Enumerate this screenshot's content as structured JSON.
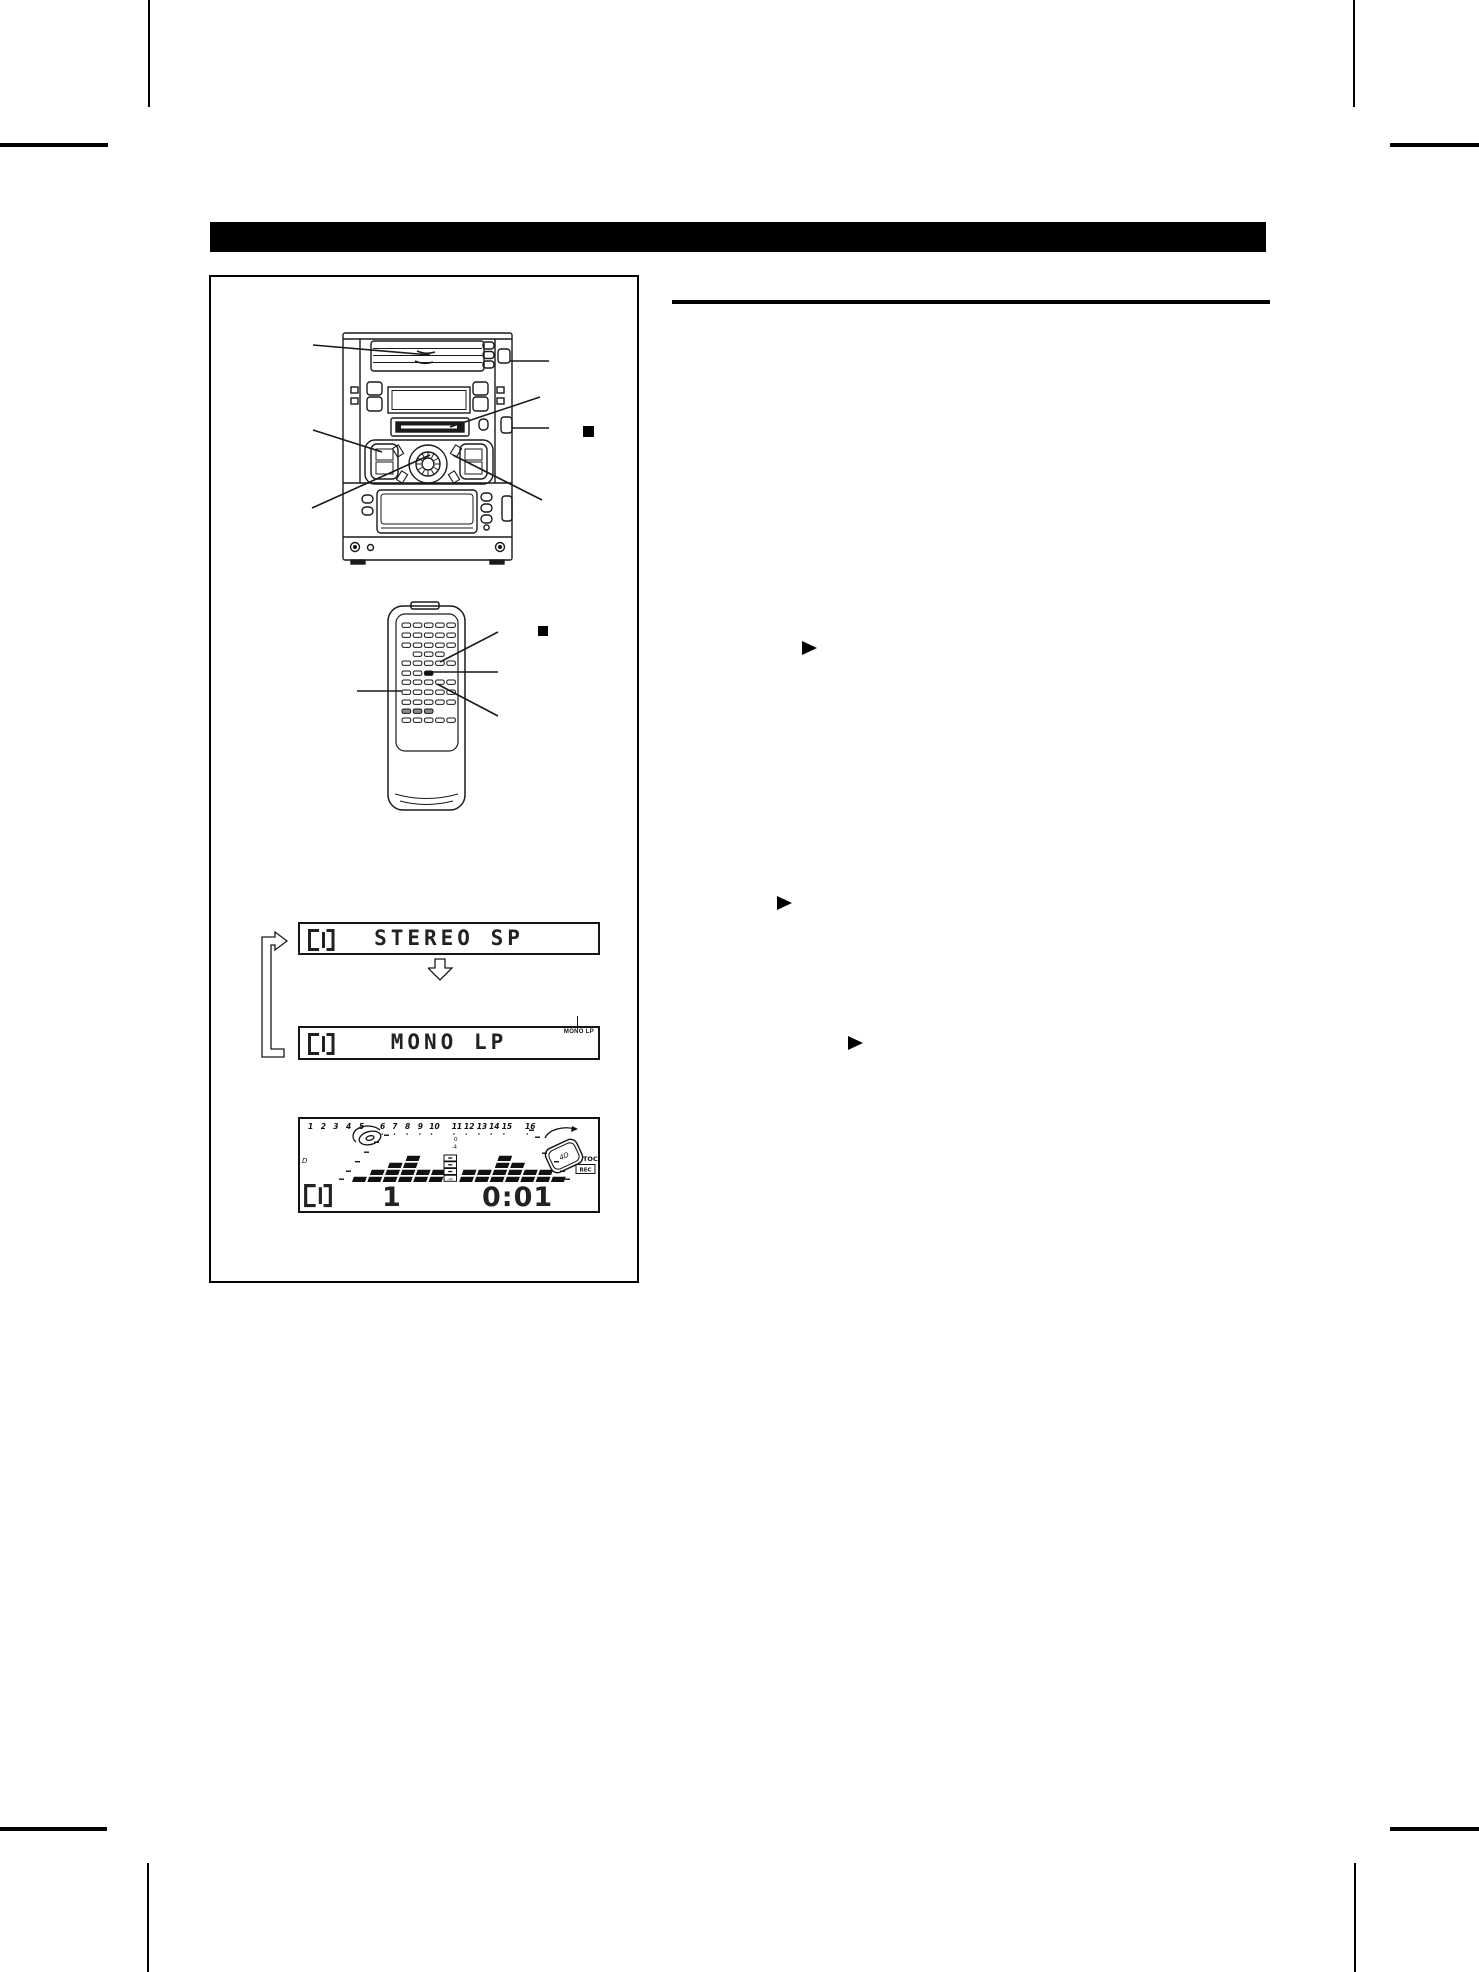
{
  "figure": {
    "flow": {
      "panel1": {
        "cd_icon": "CD",
        "text": "STEREO SP"
      },
      "panel2": {
        "cd_icon": "CD",
        "text": "MONO LP",
        "indicator": "MONO LP"
      }
    },
    "lcd": {
      "cd_icon": "CD",
      "track_numbers": [
        "1",
        "2",
        "3",
        "4",
        "5",
        "6",
        "7",
        "8",
        "9",
        "10",
        "11",
        "12",
        "13",
        "14",
        "15",
        "16"
      ],
      "level_top": "0",
      "level_mid": "-4",
      "level_bottom": "-∞",
      "disc_label": "D",
      "badge": "4D",
      "toc": "TOC",
      "rec": "REC",
      "track": "1",
      "time": "0:01",
      "eq_bars": [
        1,
        2,
        3,
        4,
        2,
        2,
        0,
        2,
        2,
        4,
        3,
        2,
        2,
        1
      ]
    }
  },
  "symbols": {
    "stop": "■",
    "play": "▶",
    "down_arrow": "⇩",
    "loop_arrow": "⮌"
  },
  "icons": {
    "cd_indicator": "cd-segment-icon",
    "rotating_disc": "rotating-disc-icon",
    "stop_marker": "stop-square-icon",
    "play_marker": "play-triangle-icon"
  }
}
